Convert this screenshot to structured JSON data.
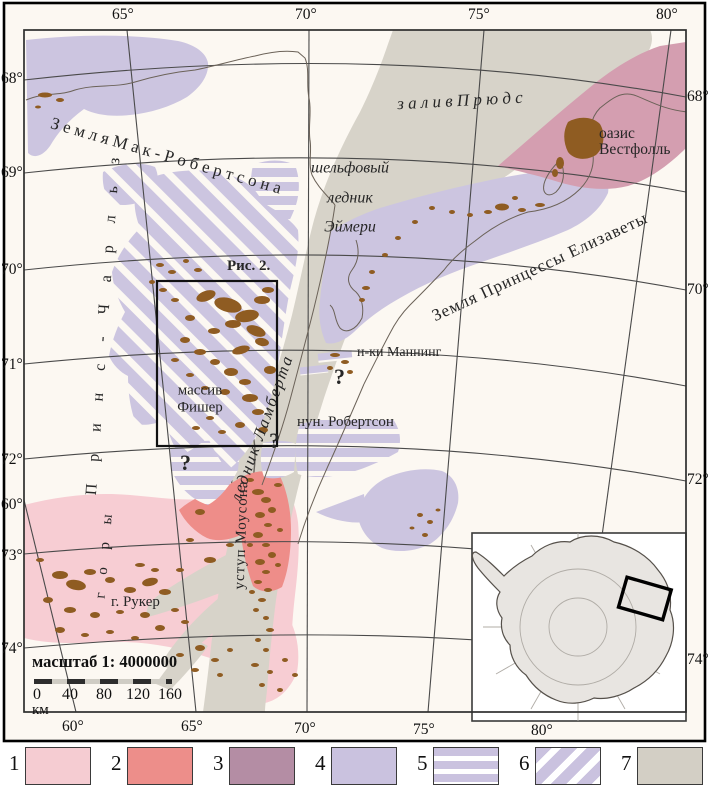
{
  "map": {
    "land_mac_robertson": "З е м л я  М а к - Р о б е р т с о н а",
    "prydz_bay": "з а л и в   П р ю д с",
    "oasis_line1": "оазис",
    "oasis_line2": "Вестфолль",
    "amery_line1": "шельфовый",
    "amery_line2": "ледник",
    "amery_line3": "Эймери",
    "princess_elizabeth_land": "Земля Принцессы Елизаветы",
    "prince_charles": "П р и н с - Ч а р л ь з",
    "mountains": "г о р ы",
    "ruker": "г. Рукер",
    "fisher_line1": "массив",
    "fisher_line2": "Фишер",
    "manning": "н-ки Маннинг",
    "robertson": "нун. Робертсон",
    "lambert_glacier": "ледник Ламберта",
    "mawson_escarpment": "уступ Моусона",
    "figure_ref": "Рис. 2.",
    "question_mark": "?"
  },
  "axes": {
    "top": [
      "65°",
      "70°",
      "75°",
      "80°"
    ],
    "bottom": [
      "60°",
      "65°",
      "70°",
      "75°",
      "80°"
    ],
    "left": [
      "68°",
      "69°",
      "70°",
      "71°",
      "72°",
      "60°",
      "73°",
      "74°"
    ],
    "right": [
      "68°",
      "70°",
      "72°",
      "74°"
    ]
  },
  "scalebar": {
    "title": "масштаб 1: 4000000",
    "ticks": [
      "0",
      "40",
      "80",
      "120",
      "160"
    ],
    "unit": "км"
  },
  "legend": {
    "items": [
      {
        "n": "1",
        "color": "#f5ccd2",
        "pattern": "solid"
      },
      {
        "n": "2",
        "color": "#ed8e8a",
        "pattern": "solid"
      },
      {
        "n": "3",
        "color": "#b48da4",
        "pattern": "solid"
      },
      {
        "n": "4",
        "color": "#cac2df",
        "pattern": "solid"
      },
      {
        "n": "5",
        "color": "#cac2df",
        "pattern": "horizontal-stripes"
      },
      {
        "n": "6",
        "color": "#cac2df",
        "pattern": "diagonal-stripes"
      },
      {
        "n": "7",
        "color": "#d3cfc5",
        "pattern": "solid"
      }
    ]
  },
  "colors": {
    "background": "#fcf8f2",
    "lilac": "#ccc5e0",
    "gray_band": "#d7d3c9",
    "pink": "#f7cdd3",
    "red": "#ee8d89",
    "rose": "#d49eb0",
    "brown": "#8f5c22",
    "outline": "#5f5b55"
  }
}
